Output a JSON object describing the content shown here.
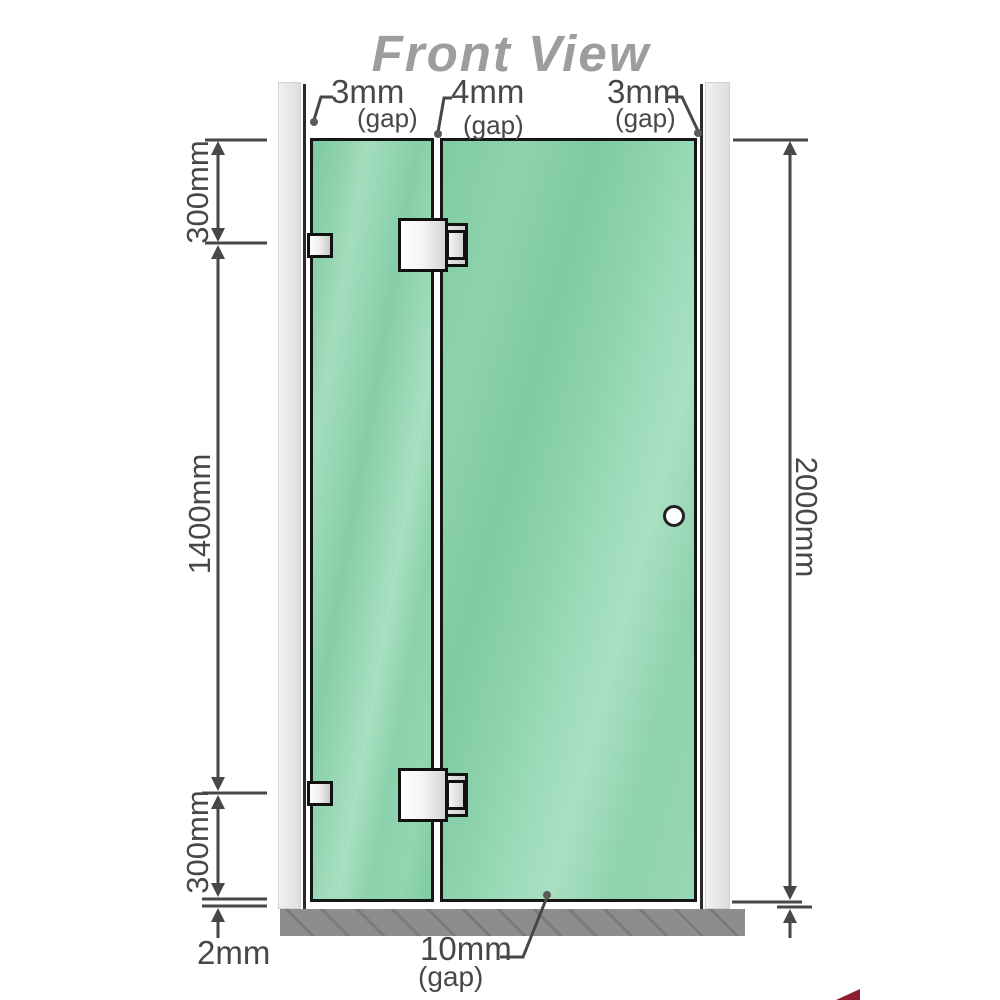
{
  "title": "Front View",
  "gaps": [
    {
      "value": "3mm",
      "unit": "(gap)"
    },
    {
      "value": "4mm",
      "unit": "(gap)"
    },
    {
      "value": "3mm",
      "unit": "(gap)"
    }
  ],
  "left_dims": [
    "300mm",
    "1400mm",
    "300mm"
  ],
  "bottom_left_dim": "2mm",
  "right_dim": "2000mm",
  "bottom_gap": {
    "value": "10mm",
    "unit": "(gap)"
  },
  "colors": {
    "glass_green": "#8ed3ae",
    "dimension_gray": "#474747",
    "title_gray": "#9d9d9d",
    "wall_gray": "#e8e8e8",
    "floor_gray": "#8d8d8d",
    "hardware_white": "#f4f4f4",
    "outline_black": "#111111",
    "watermark_red": "#8c1c30"
  }
}
